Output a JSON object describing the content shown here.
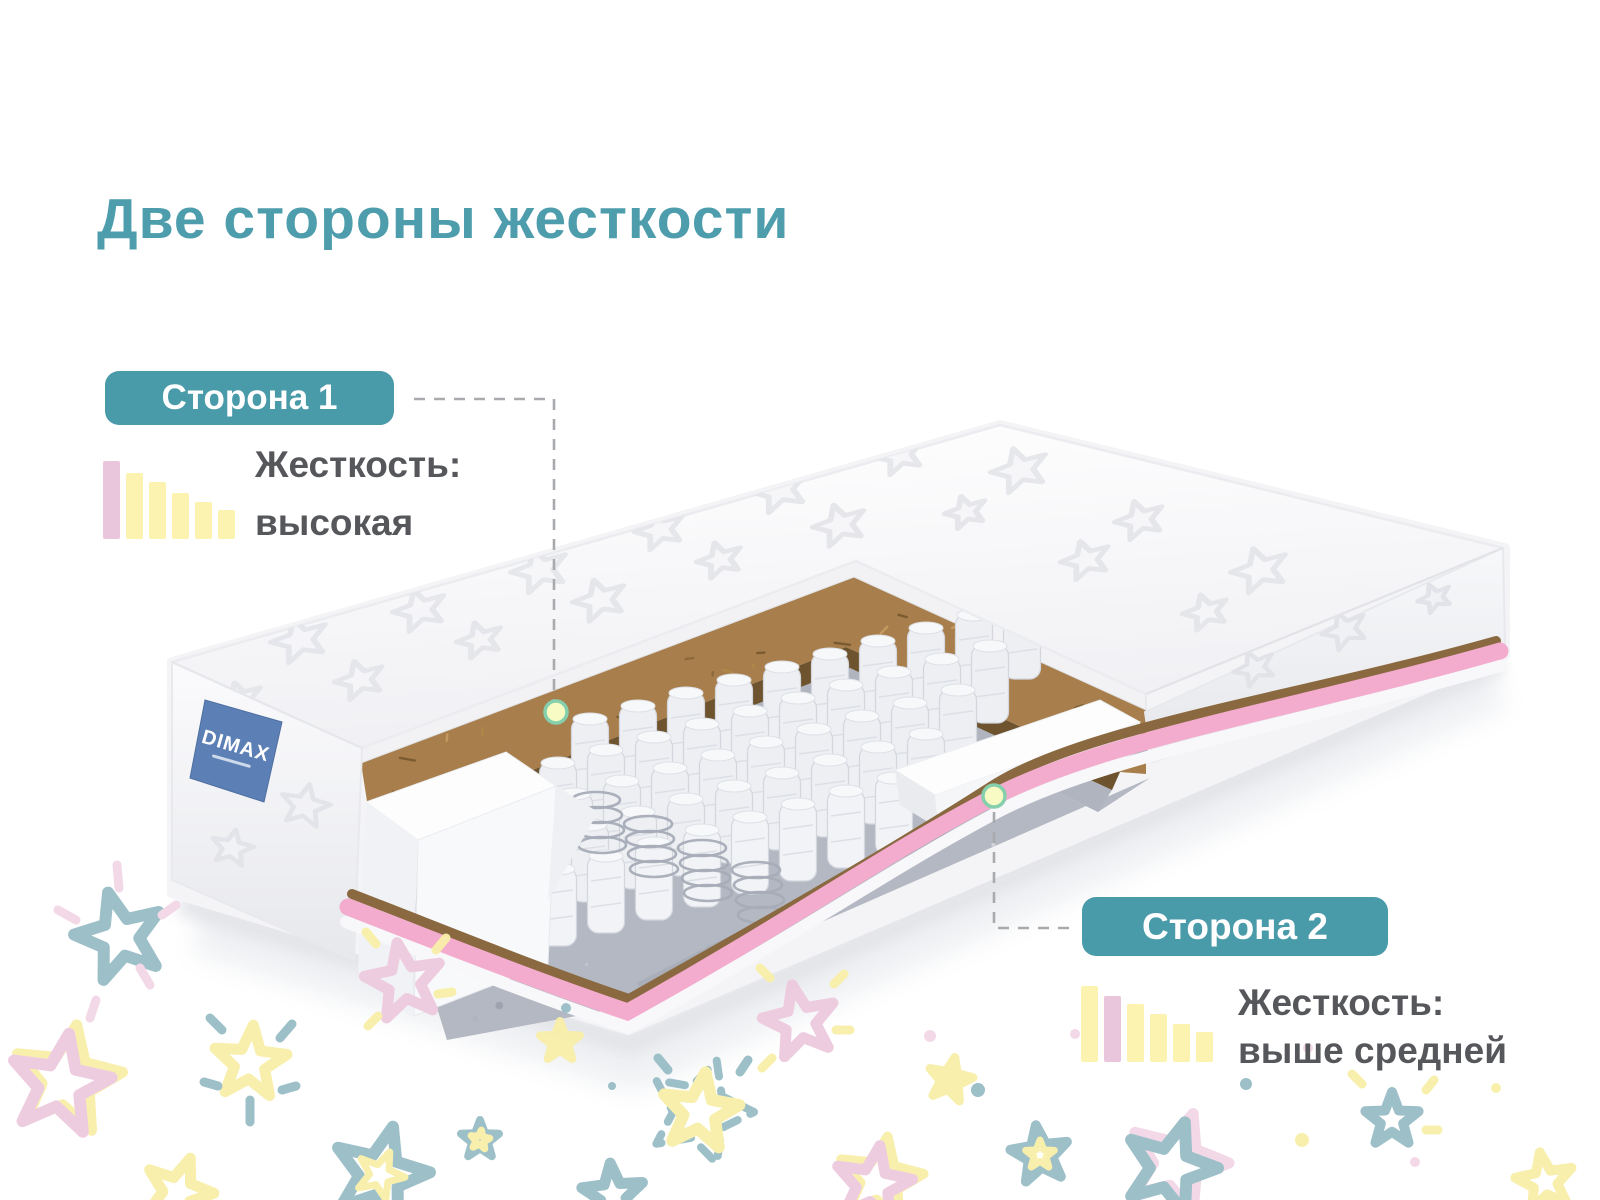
{
  "title": "Две стороны жесткости",
  "brand": {
    "tag": "DIMAX"
  },
  "side1": {
    "badge": "Сторона 1",
    "firmness_label": "Жесткость:",
    "firmness_value": "высокая",
    "scale": {
      "levels": 6,
      "active_level": 1,
      "bar_heights": [
        78,
        66,
        57,
        46,
        37,
        29
      ]
    }
  },
  "side2": {
    "badge": "Сторона 2",
    "firmness_label": "Жесткость:",
    "firmness_value": "выше средней",
    "scale": {
      "levels": 6,
      "active_level": 2,
      "bar_heights": [
        76,
        66,
        58,
        48,
        38,
        30
      ]
    }
  },
  "colors": {
    "accent_teal": "#4A9BAA",
    "title_teal": "#4E9DAD",
    "text_gray": "#56575B",
    "bar_yellow": "#FBF3AF",
    "bar_pink": "#E9C6DC",
    "pink_layer": "#F3ABCE",
    "coir_brown": "#A87F4C",
    "felt_gray": "#B4B8C2",
    "label_blue": "#5C80B6",
    "dot_fill": "#F8FBC3",
    "dot_stroke": "#86CFAD"
  }
}
